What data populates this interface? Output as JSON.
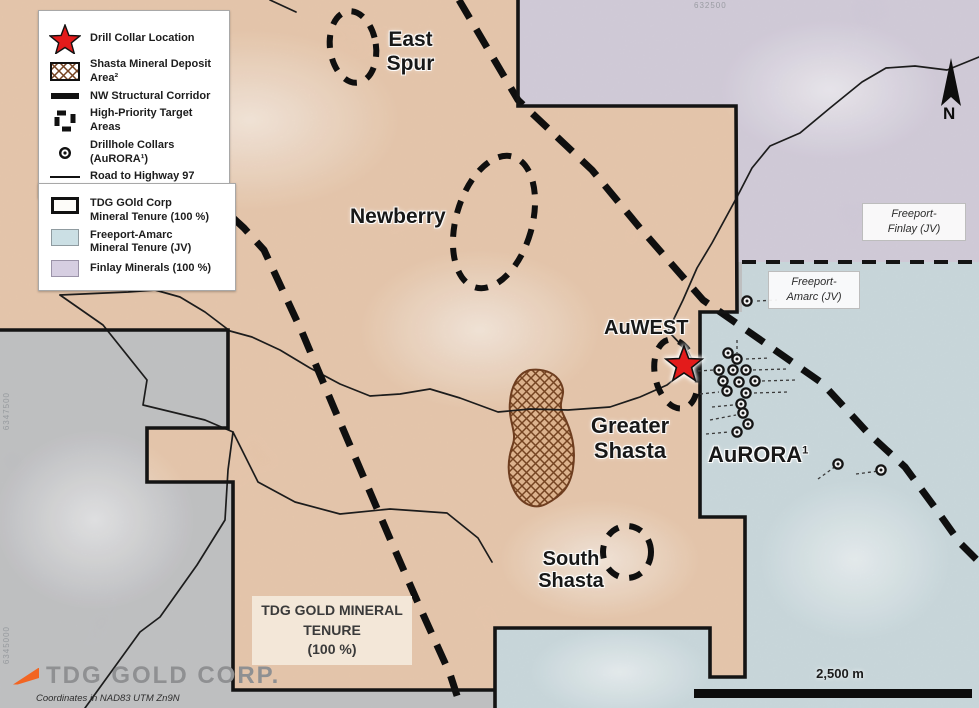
{
  "colors": {
    "tdg_tenure": "#e5c1a2",
    "freeport_amarc": "#c4d5da",
    "finlay": "#cdc6d6",
    "background": "#b9babd",
    "star_red": "#e31b1b",
    "line_black": "#141414",
    "hatch_brown": "#754422",
    "logo_orange": "#f26522"
  },
  "legend_symbols": {
    "items": [
      {
        "icon": "star-icon",
        "label": "Drill Collar Location"
      },
      {
        "icon": "hatch-swatch",
        "label": "Shasta Mineral Deposit Area²"
      },
      {
        "icon": "thick-line",
        "label": "NW Structural Corridor"
      },
      {
        "icon": "dashed-corner",
        "label": "High-Priority Target Areas"
      },
      {
        "icon": "collar-circle",
        "label": "Drillhole Collars (AuRORA¹)"
      },
      {
        "icon": "thin-line",
        "label": "Road to Highway 97"
      }
    ]
  },
  "legend_tenure": {
    "items": [
      {
        "icon": "outline-swatch",
        "label": "TDG GOld Corp\nMineral Tenure (100 %)"
      },
      {
        "icon": "blue-swatch",
        "label": "Freeport-Amarc\nMineral Tenure (JV)"
      },
      {
        "icon": "purple-swatch",
        "label": "Finlay Minerals (100 %)"
      }
    ]
  },
  "map_labels": {
    "east_spur": "East\nSpur",
    "newberry": "Newberry",
    "auwest": "AuWEST",
    "greater_shasta": "Greater\nShasta",
    "aurora": "AuRORA",
    "aurora_sup": "1",
    "south_shasta": "South\nShasta"
  },
  "boxes": {
    "freeport_finlay": "Freeport-\nFinlay (JV)",
    "freeport_amarc": "Freeport-\nAmarc (JV)",
    "tdg_tenure": "TDG GOLD MINERAL\nTENURE\n(100 %)"
  },
  "scale": {
    "label": "2,500 m"
  },
  "north": {
    "label": "N"
  },
  "footer": {
    "logo": "TDG GOLD CORP.",
    "coords": "Coordinates in NAD83 UTM Zn9N"
  },
  "grid_refs": {
    "top": "632500",
    "left_mid": "6347500",
    "left_bottom": "6345000"
  },
  "drill_collars": [
    [
      747,
      301
    ],
    [
      728,
      353
    ],
    [
      737,
      359
    ],
    [
      719,
      370
    ],
    [
      733,
      370
    ],
    [
      746,
      370
    ],
    [
      723,
      381
    ],
    [
      739,
      382
    ],
    [
      755,
      381
    ],
    [
      727,
      391
    ],
    [
      746,
      393
    ],
    [
      741,
      404
    ],
    [
      743,
      413
    ],
    [
      748,
      424
    ],
    [
      737,
      432
    ],
    [
      838,
      464
    ],
    [
      881,
      470
    ]
  ]
}
